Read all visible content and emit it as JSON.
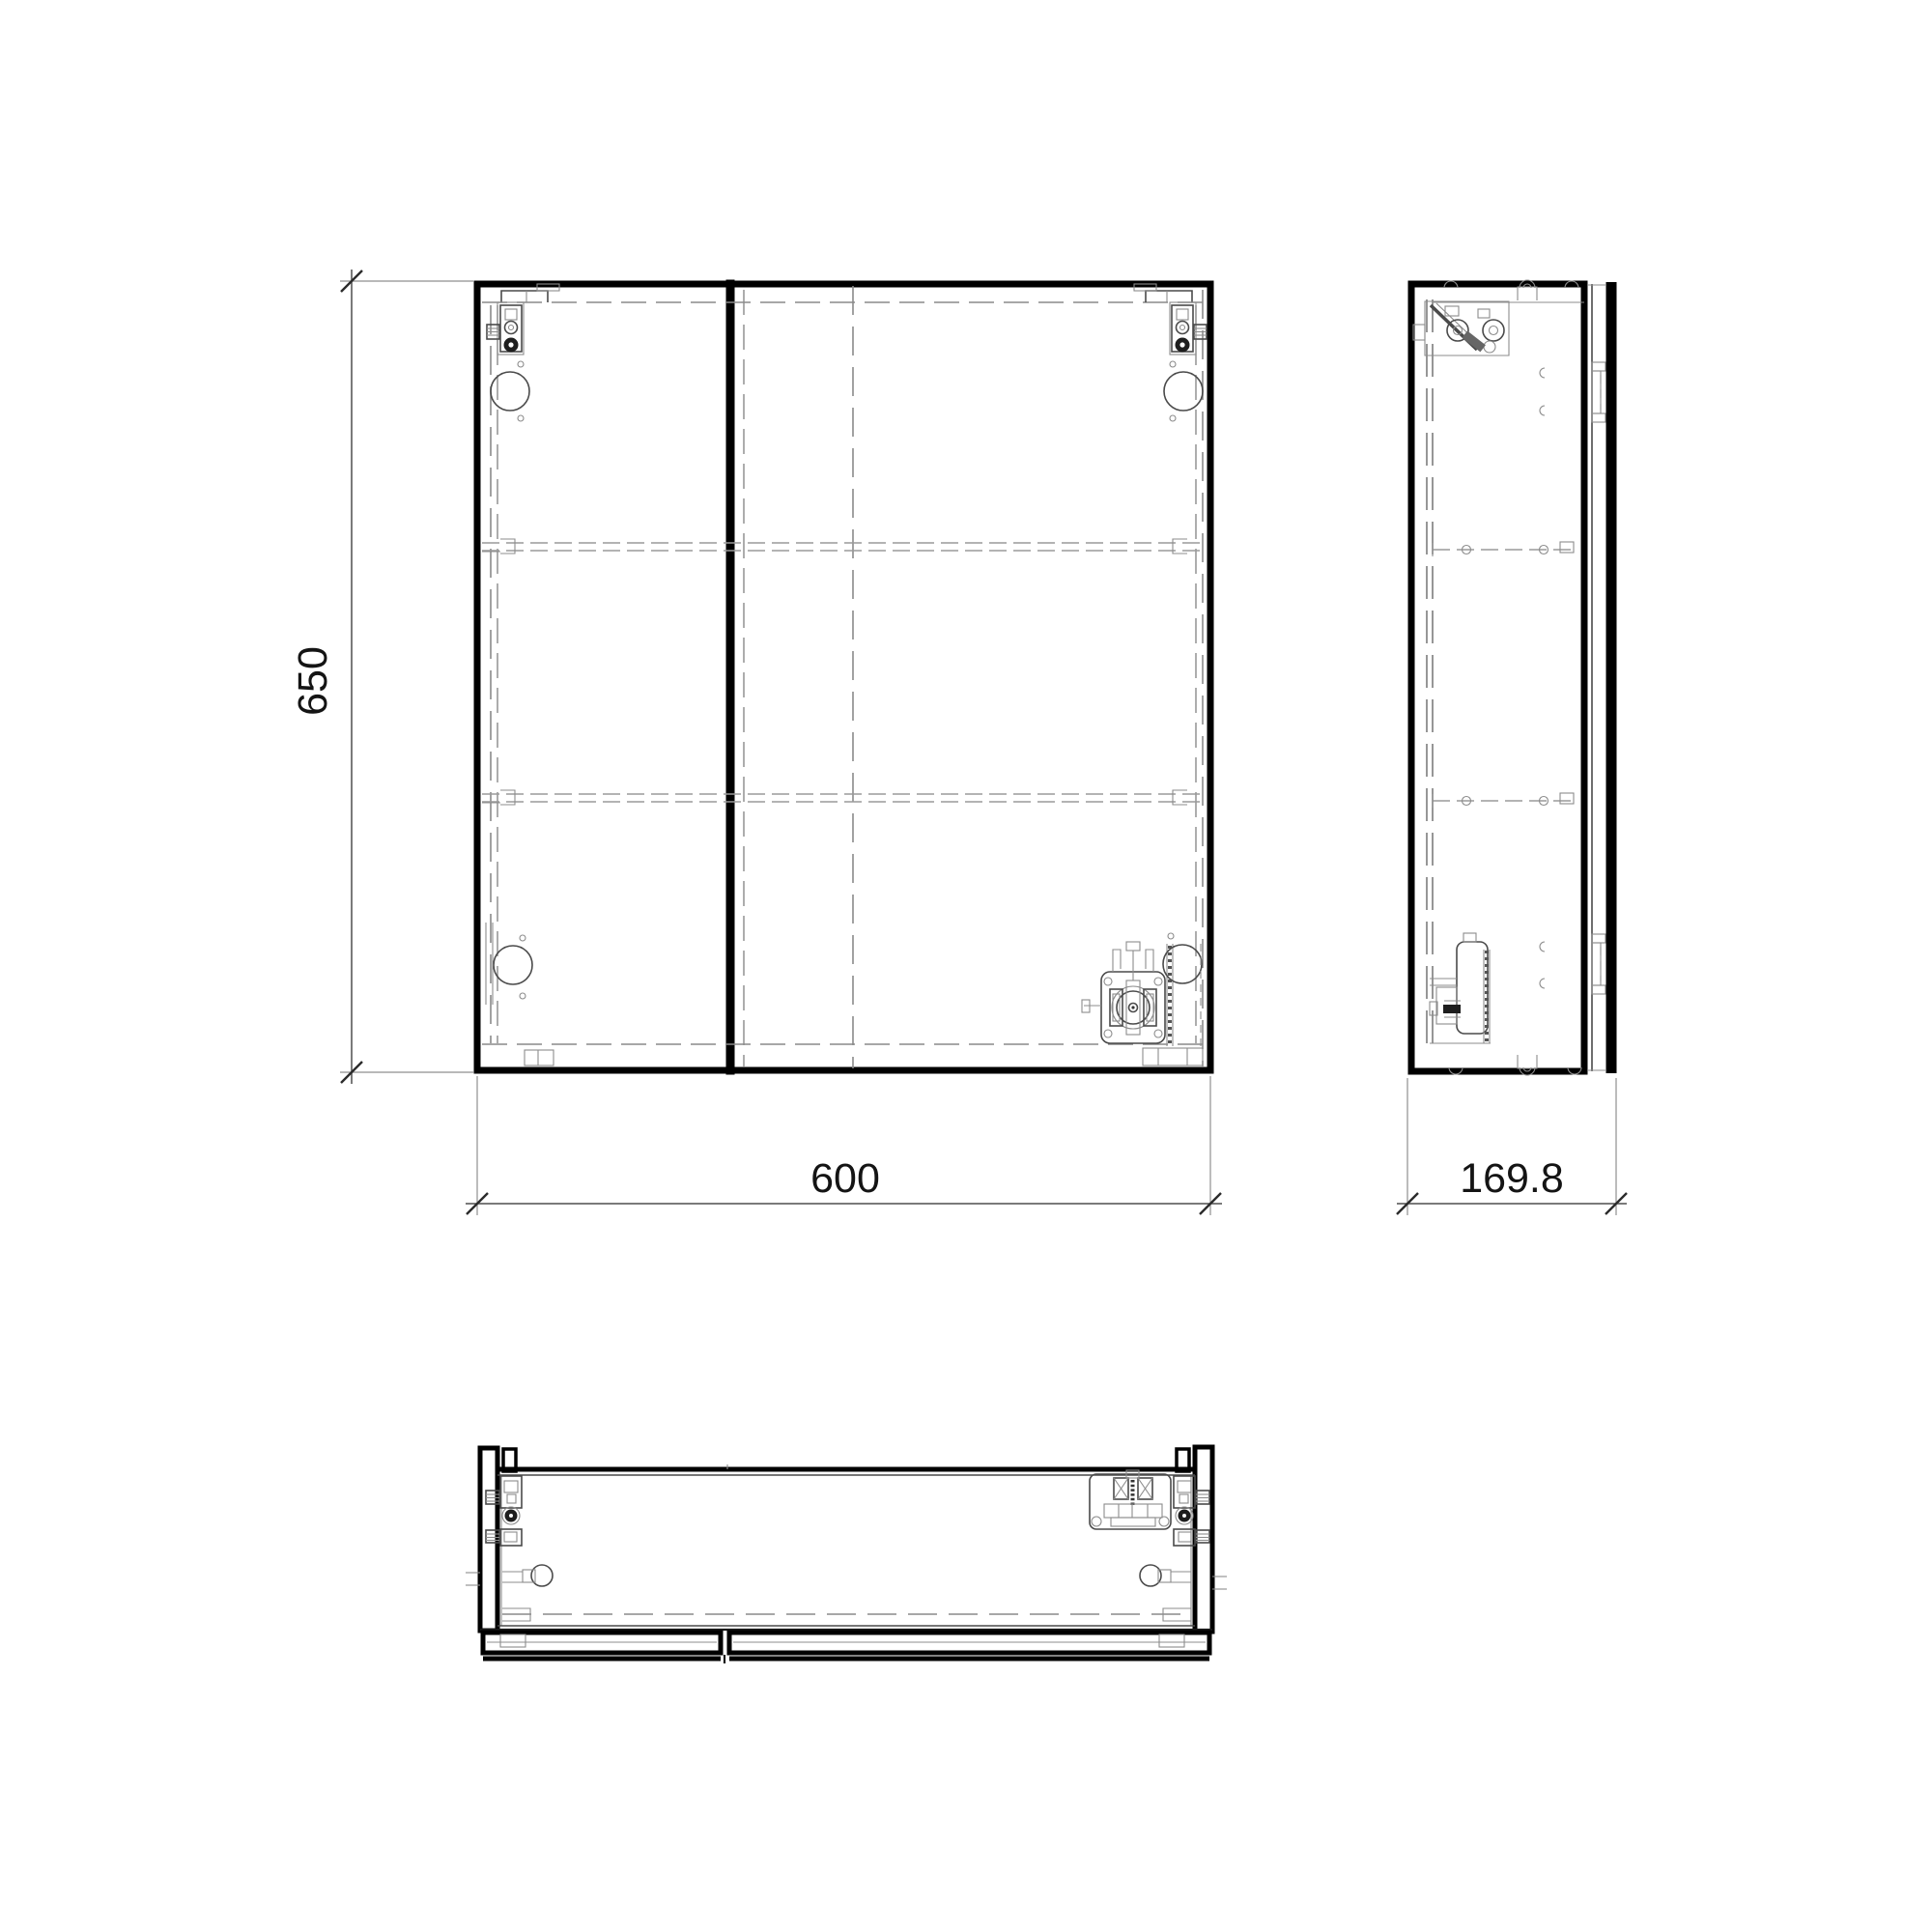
{
  "drawing": {
    "background_color": "#ffffff",
    "line_color": "#000000",
    "dimensions": {
      "height": "650",
      "width": "600",
      "depth": "169.8"
    }
  }
}
